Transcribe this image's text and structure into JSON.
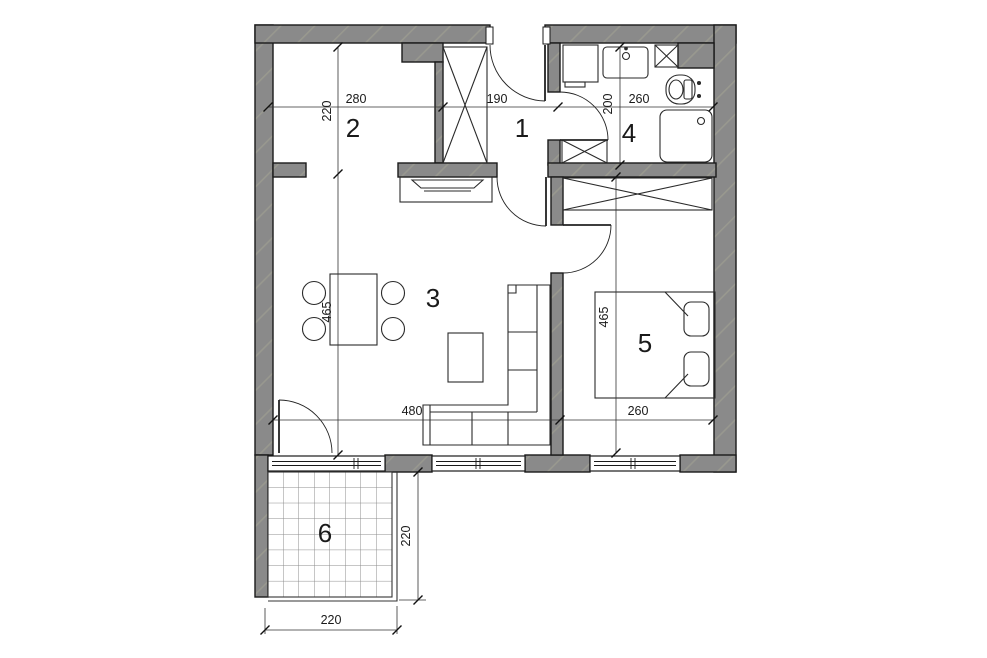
{
  "floorplan": {
    "colors": {
      "background": "#ffffff",
      "wall": "#8a8a8a",
      "wall_streak": "#98988f",
      "line": "#1a1a1a",
      "dim_line": "#333333",
      "tile_line": "#8c8c8c"
    },
    "rooms": {
      "hall": {
        "number": "1"
      },
      "kitchen": {
        "number": "2"
      },
      "living": {
        "number": "3"
      },
      "bathroom": {
        "number": "4"
      },
      "bedroom": {
        "number": "5"
      },
      "balcony": {
        "number": "6"
      }
    },
    "dims": {
      "top_280": "280",
      "top_190": "190",
      "top_260": "260",
      "left_220": "220",
      "left_465": "465",
      "bath_200": "200",
      "bed_465": "465",
      "bottom_480": "480",
      "bottom_260": "260",
      "balcony_w_220": "220",
      "balcony_h_220": "220"
    }
  }
}
